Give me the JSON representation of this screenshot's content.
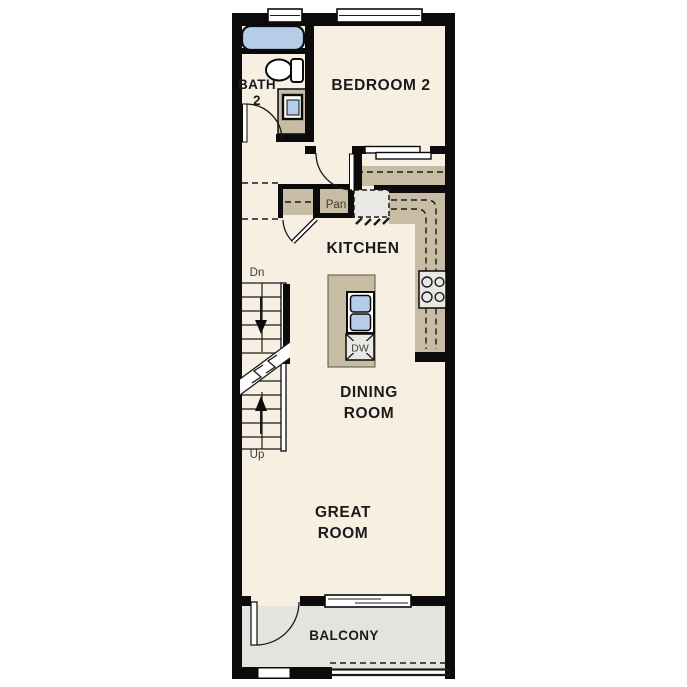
{
  "floorplan": {
    "labels": {
      "bath_line1": "BATH",
      "bath_line2": "2",
      "bedroom2": "BEDROOM 2",
      "kitchen": "KITCHEN",
      "pantry": "Pan",
      "dining_line1": "DINING",
      "dining_line2": "ROOM",
      "great_line1": "GREAT",
      "great_line2": "ROOM",
      "balcony": "BALCONY",
      "dishwasher": "DW",
      "stairs_down": "Dn",
      "stairs_up": "Up"
    },
    "colors": {
      "wall": "#0b0b0b",
      "line": "#1a1a1a",
      "floor": "#f7efe2",
      "counter": "#c9bca4",
      "balcony_floor": "#e4e3df",
      "fixture_blue": "#b6cde9",
      "appliance_gray": "#e9e8e4",
      "label_text": "#1a1a1a",
      "small_text": "#3e3c33"
    }
  }
}
